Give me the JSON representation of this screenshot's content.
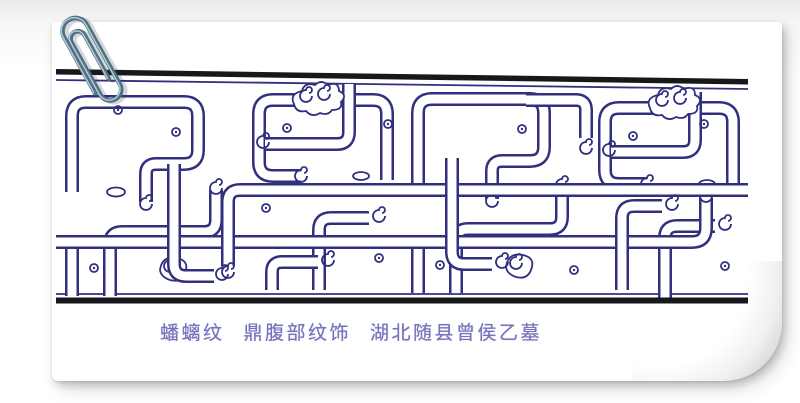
{
  "artwork": {
    "caption": {
      "motif": "蟠螭纹",
      "description": "鼎腹部纹饰",
      "provenance": "湖北随县曾侯乙墓"
    }
  },
  "icons": {
    "paperclip": "paperclip-icon"
  },
  "colors": {
    "ink": "#30307f",
    "paper": "#ffffff",
    "border_bar": "#18181c",
    "caption_text": "#7473bc",
    "page_bg_top": "#e9e9e9",
    "clip_dark": "#4f7082",
    "clip_light": "#b2cad5"
  }
}
